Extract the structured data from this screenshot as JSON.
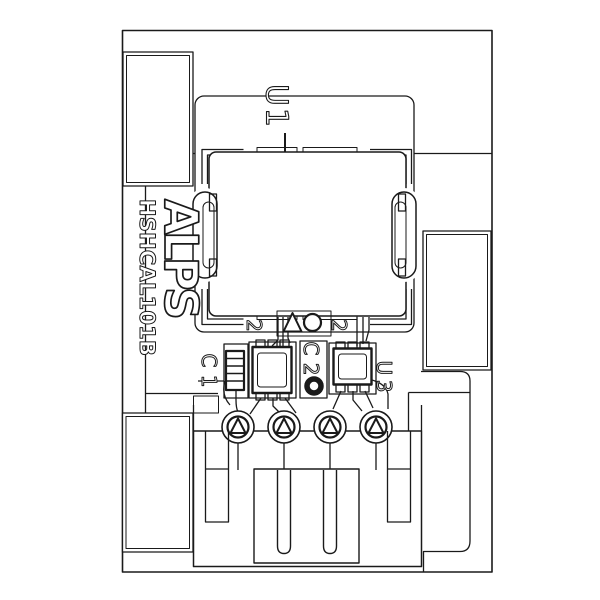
{
  "meta": {
    "description": "ALPS HSHCAL101B sensor module PCB assembly line drawing"
  },
  "labels": {
    "brand": "ALPS",
    "part_number": "HSHCAL101B",
    "sensor_ref": "U1",
    "cap1_ref": "C1",
    "cap2_ref": "C2",
    "ic_ref": "U3",
    "pin_mark_left": "2",
    "pin_mark_right": "2"
  },
  "colors": {
    "background": "#ffffff",
    "line": "#1a1a1a",
    "courtyard": "#9a9a9a"
  }
}
